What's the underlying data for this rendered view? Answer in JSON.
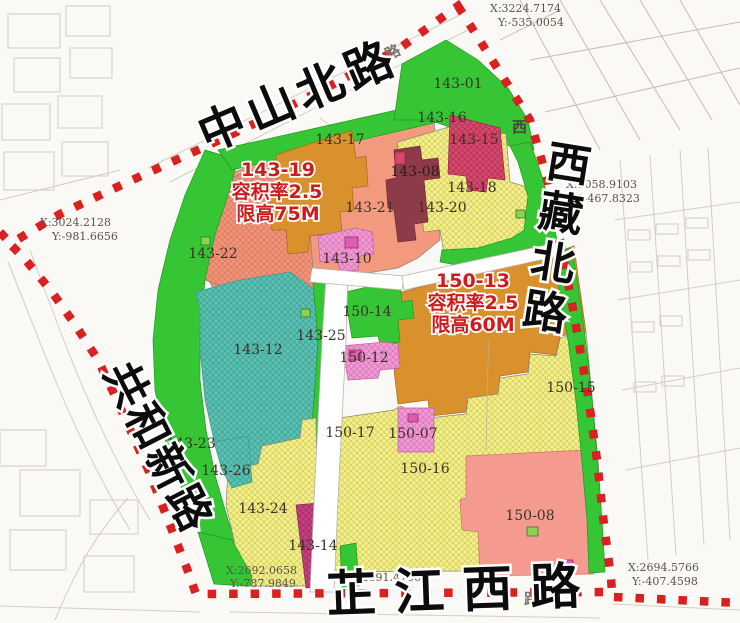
{
  "streets": [
    {
      "name": "中山北路"
    },
    {
      "name": "西藏北路"
    },
    {
      "name": "共和新路"
    },
    {
      "name": "芷江西路"
    }
  ],
  "annotations": [
    {
      "id": "143-19",
      "far": "容积率2.5",
      "height": "限高75M"
    },
    {
      "id": "150-13",
      "far": "容积率2.5",
      "height": "限高60M"
    }
  ],
  "coordinates": [
    {
      "x": "X:3224.7174",
      "y": "Y:-535.0054"
    },
    {
      "x": "X:3058.9103",
      "y": "Y:-467.8323"
    },
    {
      "x": "X:3024.2128",
      "y": "Y:-981.6656"
    },
    {
      "x": "X:2692.0658",
      "y": "Y:-787.9849"
    },
    {
      "x": "X:2691.4756",
      "y": ""
    },
    {
      "x": "X:2694.5766",
      "y": "Y:-407.4598"
    }
  ],
  "parcels": [
    {
      "id": "143-01"
    },
    {
      "id": "143-16"
    },
    {
      "id": "143-15"
    },
    {
      "id": "143-17"
    },
    {
      "id": "143-08"
    },
    {
      "id": "143-18"
    },
    {
      "id": "143-20"
    },
    {
      "id": "143-21"
    },
    {
      "id": "143-22"
    },
    {
      "id": "143-10"
    },
    {
      "id": "143-12"
    },
    {
      "id": "143-25"
    },
    {
      "id": "143-23"
    },
    {
      "id": "143-26"
    },
    {
      "id": "143-24"
    },
    {
      "id": "143-14"
    },
    {
      "id": "150-14"
    },
    {
      "id": "150-12"
    },
    {
      "id": "150-15"
    },
    {
      "id": "150-17"
    },
    {
      "id": "150-07"
    },
    {
      "id": "150-16"
    },
    {
      "id": "150-08"
    }
  ],
  "basemap_glyphs": [
    {
      "char": "路"
    },
    {
      "char": "西"
    },
    {
      "char": "路"
    }
  ],
  "colors": {
    "boundary_red": "#d92121",
    "green": "#35c535",
    "salmon": "#f2997e",
    "orange": "#d9912d",
    "teal": "#5cc0b1",
    "yellow": "#f2ef8f",
    "pink": "#ef9ad3",
    "crimson": "#d4496c",
    "maroon": "#8e3b49",
    "magenta": "#c3417f",
    "salmon_pink": "#f59a8e",
    "annotation_red": "#ce1c1c",
    "street_text": "#0c0c0c"
  }
}
